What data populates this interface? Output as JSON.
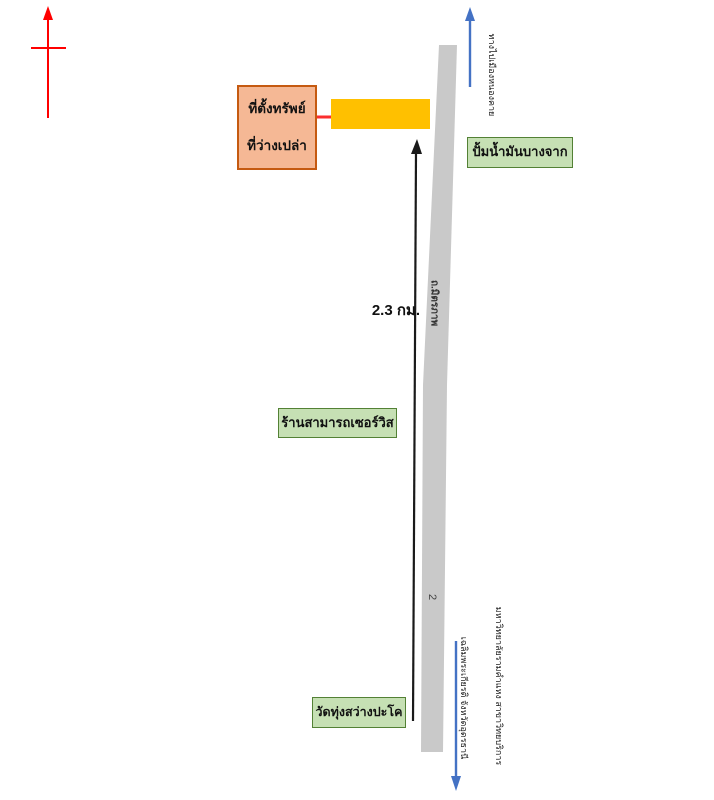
{
  "map_title": "property-location-sketch-map",
  "compass": {
    "name": "north-arrow",
    "color": "#FF0000"
  },
  "property": {
    "callout_line1": "ที่ตั้งทรัพย์",
    "callout_line2": "ที่ว่างเปล่า",
    "callout_fill": "#F5B895",
    "callout_border": "#C55A11",
    "marker_fill": "#FFC000",
    "pointer_arrow_color": "#FB2E2E"
  },
  "road": {
    "name": "ถ.มิตรภาพ",
    "route_number": "2",
    "fill": "#C9C9C9"
  },
  "distance": {
    "label": "2.3 กม.",
    "measure_arrow_color": "#1A1A1A"
  },
  "landmarks": {
    "gas_station": "ปั้มน้ำมันบางจาก",
    "service_shop": "ร้านสามารถเซอร์วิส",
    "temple": "วัดทุ่งสว่างปะโค",
    "box_fill": "#C6E0B4",
    "box_border": "#538135"
  },
  "directions": {
    "north_label": "ทางไปเมืองหนองคาย",
    "south_label_line1": "มหาวิทยาลัยรามคำแหง สาขาวิทยบริการ",
    "south_label_line2": "เฉลิมพระเกียรติ จังหวัดอุดรธานี",
    "arrow_color": "#4472C4"
  }
}
